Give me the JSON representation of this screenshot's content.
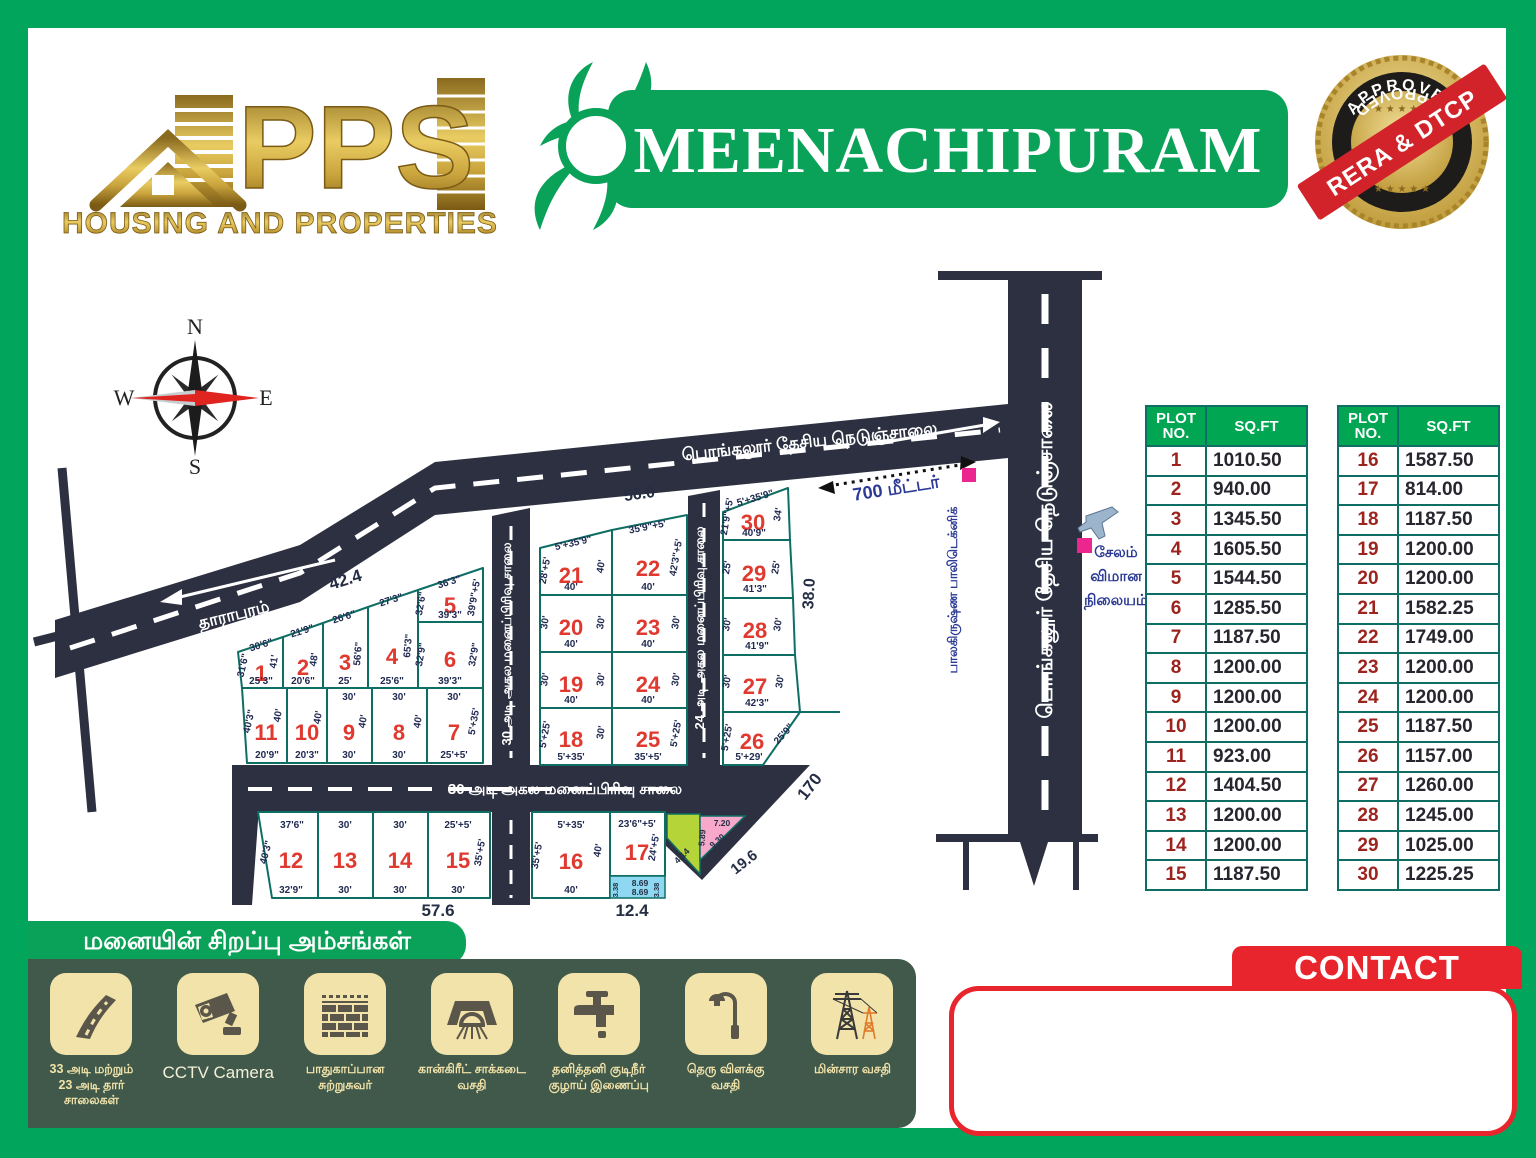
{
  "brand": {
    "name": "PPS",
    "tagline": "HOUSING AND PROPERTIES"
  },
  "title": "MEENACHIPURAM",
  "badge": {
    "top": "APPROVED",
    "bottom": "APPROVED",
    "ribbon": "RERA & DTCP",
    "stars": "★ ★ ★ ★ ★"
  },
  "compass": {
    "n": "N",
    "e": "E",
    "s": "S",
    "w": "W"
  },
  "map": {
    "direction_left": "தாராபுரம்",
    "highway": "பொங்கலூர் தேசிய நெடுஞ்சாலை",
    "highway_vertical": "பொங்கலூர் தேசிய நெடுஞ்சாலை",
    "road30_left": "30 அடி அகல மனைப்பிரிவு சாலை",
    "road30_bottom": "30 அடி அகல மனைப்பிரிவு சாலை",
    "road24": "24 அடி அகல மனைப்பிரிவு சாலை",
    "polytechnic": "பாலகிருஷ்ண பாலிடெக்னிக்",
    "airport": {
      "l1": "சேலம்",
      "l2": "விமான",
      "l3": "நிலையம்"
    },
    "distance": "700 மீட்டர்",
    "meas": {
      "m424": "42.4",
      "m560": "56.0",
      "m380": "38.0",
      "m170": "170",
      "m196": "19.6",
      "m576": "57.6",
      "m124": "12.4"
    },
    "strip": {
      "a": "3.38",
      "b": "8.69",
      "c": "8.69",
      "d": "3.38"
    },
    "wedge": {
      "a": "4.14",
      "b": "5.89",
      "c": "7.20",
      "d": "9.30"
    },
    "plots": [
      {
        "no": "1",
        "t": "30'6\"",
        "b": "25'3\"",
        "l": "31'6\"",
        "r": "41'"
      },
      {
        "no": "2",
        "t": "21'9\"",
        "b": "20'6\"",
        "r": "48'"
      },
      {
        "no": "3",
        "t": "26'6\"",
        "b": "25'",
        "r": "56'6\""
      },
      {
        "no": "4",
        "t": "27'3\"",
        "b": "25'6\"",
        "r": "65'3\""
      },
      {
        "no": "5",
        "t": "36'3\"",
        "b": "39'3\"",
        "l": "32'6\"",
        "r": "39'9\"+5'"
      },
      {
        "no": "6",
        "b": "39'3\"",
        "l": "32'9\"",
        "r": "32'9\""
      },
      {
        "no": "7",
        "t": "30'",
        "b": "25'+5'",
        "r": "5'+35'"
      },
      {
        "no": "8",
        "t": "30'",
        "b": "30'",
        "r": "40'"
      },
      {
        "no": "9",
        "t": "30'",
        "b": "30'",
        "r": "40'"
      },
      {
        "no": "10",
        "b": "20'3\"",
        "r": "40'"
      },
      {
        "no": "11",
        "b": "20'9\"",
        "l": "40'3\"",
        "r": "40'"
      },
      {
        "no": "12",
        "t": "37'6\"",
        "b": "32'9\"",
        "l": "40'3\""
      },
      {
        "no": "13",
        "t": "30'",
        "b": "30'"
      },
      {
        "no": "14",
        "t": "30'",
        "b": "30'"
      },
      {
        "no": "15",
        "t": "25'+5'",
        "b": "30'",
        "r": "35'+5'"
      },
      {
        "no": "16",
        "t": "5'+35'",
        "b": "40'",
        "l": "35'+5'",
        "r": "40'"
      },
      {
        "no": "17",
        "t": "23'6\"+5'",
        "r": "24'+5'"
      },
      {
        "no": "18",
        "b": "5'+35'",
        "l": "5'+25'",
        "r": "30'"
      },
      {
        "no": "19",
        "b": "40'",
        "l": "30'",
        "r": "30'"
      },
      {
        "no": "20",
        "b": "40'",
        "l": "30'",
        "r": "30'"
      },
      {
        "no": "21",
        "t": "5'+35'9\"",
        "b": "40'",
        "l": "28'+5'",
        "r": "40'"
      },
      {
        "no": "22",
        "t": "35'9\"+5'",
        "b": "40'",
        "r": "42'3\"+5'"
      },
      {
        "no": "23",
        "b": "40'",
        "r": "30'"
      },
      {
        "no": "24",
        "b": "40'",
        "r": "30'"
      },
      {
        "no": "25",
        "b": "35'+5'",
        "r": "5'+25'"
      },
      {
        "no": "26",
        "b": "5'+29'",
        "l": "5'+25'",
        "r": "25'9\""
      },
      {
        "no": "27",
        "b": "42'3\"",
        "l": "30'",
        "r": "30'"
      },
      {
        "no": "28",
        "b": "41'9\"",
        "l": "30'",
        "r": "30'"
      },
      {
        "no": "29",
        "b": "41'3\"",
        "l": "25'",
        "r": "25'"
      },
      {
        "no": "30",
        "t": "5'+35'9\"",
        "b": "40'9\"",
        "l": "21'9\"+5'",
        "r": "34'"
      }
    ]
  },
  "tables": [
    {
      "headers": [
        "PLOT\nNO.",
        "SQ.FT"
      ],
      "rows": [
        {
          "no": "1",
          "sqft": "1010.50"
        },
        {
          "no": "2",
          "sqft": "940.00"
        },
        {
          "no": "3",
          "sqft": "1345.50"
        },
        {
          "no": "4",
          "sqft": "1605.50"
        },
        {
          "no": "5",
          "sqft": "1544.50"
        },
        {
          "no": "6",
          "sqft": "1285.50"
        },
        {
          "no": "7",
          "sqft": "1187.50"
        },
        {
          "no": "8",
          "sqft": "1200.00"
        },
        {
          "no": "9",
          "sqft": "1200.00"
        },
        {
          "no": "10",
          "sqft": "1200.00"
        },
        {
          "no": "11",
          "sqft": "923.00"
        },
        {
          "no": "12",
          "sqft": "1404.50"
        },
        {
          "no": "13",
          "sqft": "1200.00"
        },
        {
          "no": "14",
          "sqft": "1200.00"
        },
        {
          "no": "15",
          "sqft": "1187.50"
        }
      ]
    },
    {
      "headers": [
        "PLOT\nNO.",
        "SQ.FT"
      ],
      "rows": [
        {
          "no": "16",
          "sqft": "1587.50"
        },
        {
          "no": "17",
          "sqft": "814.00"
        },
        {
          "no": "18",
          "sqft": "1187.50"
        },
        {
          "no": "19",
          "sqft": "1200.00"
        },
        {
          "no": "20",
          "sqft": "1200.00"
        },
        {
          "no": "21",
          "sqft": "1582.25"
        },
        {
          "no": "22",
          "sqft": "1749.00"
        },
        {
          "no": "23",
          "sqft": "1200.00"
        },
        {
          "no": "24",
          "sqft": "1200.00"
        },
        {
          "no": "25",
          "sqft": "1187.50"
        },
        {
          "no": "26",
          "sqft": "1157.00"
        },
        {
          "no": "27",
          "sqft": "1260.00"
        },
        {
          "no": "28",
          "sqft": "1245.00"
        },
        {
          "no": "29",
          "sqft": "1025.00"
        },
        {
          "no": "30",
          "sqft": "1225.25"
        }
      ]
    }
  ],
  "features": {
    "heading": "மனையின் சிறப்பு அம்சங்கள்",
    "items": [
      {
        "icon": "road-icon",
        "label": "33 அடி மற்றும்\n23 அடி தார் சாலைகள்"
      },
      {
        "icon": "cctv-camera-icon",
        "label": "CCTV Camera"
      },
      {
        "icon": "compound-wall-icon",
        "label": "பாதுகாப்பான\nசுற்றுசுவர்"
      },
      {
        "icon": "drainage-icon",
        "label": "கான்கிரீட் சாக்கடை\nவசதி"
      },
      {
        "icon": "water-tap-icon",
        "label": "தனித்தனி குடிநீர்\nகுழாய் இணைப்பு"
      },
      {
        "icon": "street-light-icon",
        "label": "தெரு விளக்கு\nவசதி"
      },
      {
        "icon": "electric-tower-icon",
        "label": "மின்சார வசதி"
      }
    ]
  },
  "contact": {
    "label": "CONTACT"
  },
  "colors": {
    "frame_green": "#02a55c",
    "banner_green": "#0aa158",
    "table_header_green": "#00a651",
    "road_dark": "#2c3040",
    "plot_border_teal": "#0e6e64",
    "plot_number_red": "#e0392f",
    "table_no_maroon": "#9c241e",
    "dim_navy": "#222b52",
    "landmark_blue": "#2b3a94",
    "marker_pink": "#ec268f",
    "contact_red": "#e8252c",
    "logo_gold": "#c9a13b",
    "panel_green": "#40594a",
    "tile_cream": "#f2e3aa"
  }
}
